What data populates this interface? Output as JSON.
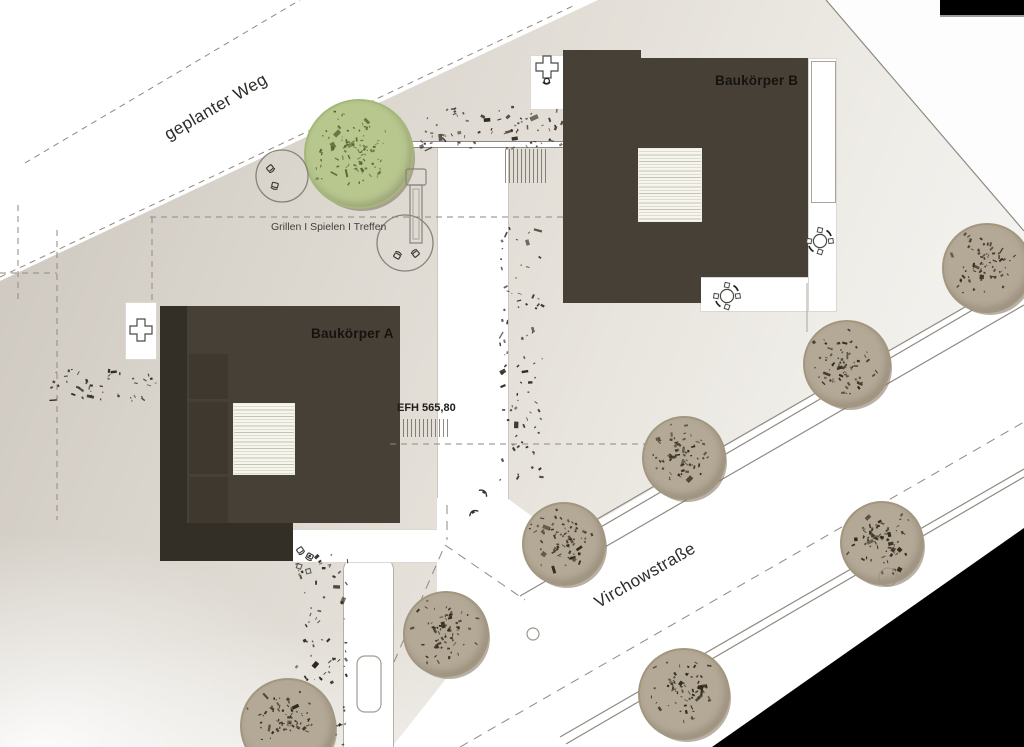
{
  "labels": {
    "geplanter_weg": "geplanter Weg",
    "grillen": "Grillen I Spielen I Treffen",
    "baukoerper_a": "Baukörper A",
    "baukoerper_b": "Baukörper B",
    "efh": "EFH 565,80",
    "virchowstrasse": "Virchowstraße"
  },
  "colors": {
    "building": "#474036",
    "building_dark": "#332e26",
    "building_inset": "#3e382e",
    "site_light": "#e6e2db",
    "site_dark": "#cbc5bc",
    "tree_fill": "#b4a996",
    "tree_ring": "#a2967f",
    "tree_speckle": "#2e281e",
    "green_tree_fill": "#b7c78e",
    "green_tree_ring": "#a3b878",
    "green_tree_speckle": "#4d5c2b",
    "line": "#8f8a82",
    "black_artifact": "#000000"
  },
  "trees": [
    {
      "x": 357,
      "y": 152,
      "r": 53,
      "kind": "green",
      "seed": 11
    },
    {
      "x": 985,
      "y": 266,
      "r": 43,
      "kind": "brown",
      "seed": 21
    },
    {
      "x": 845,
      "y": 362,
      "r": 42,
      "kind": "brown",
      "seed": 22
    },
    {
      "x": 682,
      "y": 456,
      "r": 40,
      "kind": "brown",
      "seed": 23
    },
    {
      "x": 562,
      "y": 542,
      "r": 40,
      "kind": "brown",
      "seed": 24
    },
    {
      "x": 880,
      "y": 541,
      "r": 40,
      "kind": "brown",
      "seed": 25
    },
    {
      "x": 444,
      "y": 632,
      "r": 41,
      "kind": "brown",
      "seed": 26
    },
    {
      "x": 286,
      "y": 724,
      "r": 46,
      "kind": "brown",
      "seed": 27
    },
    {
      "x": 682,
      "y": 692,
      "r": 44,
      "kind": "brown",
      "seed": 28
    }
  ],
  "speckle_patches": [
    {
      "x": 420,
      "y": 108,
      "w": 150,
      "h": 40,
      "n": 75,
      "seed": 1
    },
    {
      "x": 50,
      "y": 368,
      "w": 115,
      "h": 34,
      "n": 48,
      "seed": 2
    },
    {
      "x": 500,
      "y": 222,
      "w": 42,
      "h": 260,
      "n": 85,
      "seed": 3
    },
    {
      "x": 296,
      "y": 554,
      "w": 52,
      "h": 192,
      "n": 90,
      "seed": 4
    }
  ],
  "lines": [
    [
      "d",
      25,
      163,
      300,
      0
    ],
    [
      "d",
      0,
      277,
      575,
      5
    ],
    [
      "d",
      18,
      205,
      18,
      300
    ],
    [
      "d",
      57,
      230,
      57,
      520
    ],
    [
      "d",
      0,
      273,
      57,
      273
    ],
    [
      "d",
      150,
      217,
      563,
      217
    ],
    [
      "d",
      152,
      217,
      152,
      302
    ],
    [
      "d",
      390,
      444,
      645,
      444
    ],
    [
      "s",
      826,
      0,
      1024,
      231
    ],
    [
      "t",
      807,
      283,
      807,
      332
    ],
    [
      "s",
      540,
      552,
      1024,
      273
    ],
    [
      "s",
      546,
      559,
      1024,
      280
    ],
    [
      "s",
      520,
      596,
      1024,
      305
    ],
    [
      "s",
      560,
      737,
      1024,
      469
    ],
    [
      "s",
      566,
      744,
      1024,
      477
    ],
    [
      "D",
      460,
      747,
      1024,
      422
    ],
    [
      "D",
      394,
      662,
      445,
      545
    ],
    [
      "D",
      445,
      545,
      525,
      600
    ],
    [
      "D",
      447,
      505,
      447,
      540
    ]
  ],
  "icons": [
    {
      "type": "cross_table",
      "x": 141,
      "y": 330,
      "chair": false
    },
    {
      "type": "cross_table",
      "x": 547,
      "y": 67,
      "chair": true
    },
    {
      "type": "round_table",
      "x": 727,
      "y": 296
    },
    {
      "type": "round_table",
      "x": 820,
      "y": 241
    },
    {
      "type": "seat_circle",
      "x": 282,
      "y": 176,
      "r": 27,
      "chairs": [
        [
          -12,
          -8,
          -40
        ],
        [
          -7,
          9,
          15
        ]
      ]
    },
    {
      "type": "seat_circle",
      "x": 405,
      "y": 243,
      "r": 29,
      "chairs": [
        [
          -8,
          13,
          210
        ],
        [
          11,
          11,
          140
        ]
      ]
    },
    {
      "type": "play_tower",
      "x": 416,
      "y": 207
    },
    {
      "type": "chair_pair",
      "x": 306,
      "y": 556
    },
    {
      "type": "bench",
      "x": 484,
      "y": 492,
      "rot": 40
    },
    {
      "type": "bench",
      "x": 473,
      "y": 512,
      "rot": -30
    },
    {
      "type": "circle",
      "x": 533,
      "y": 634,
      "r": 7
    },
    {
      "type": "circle",
      "x": 888,
      "y": 577,
      "r": 10
    },
    {
      "type": "car",
      "x": 369,
      "y": 684,
      "w": 26,
      "h": 58
    }
  ]
}
